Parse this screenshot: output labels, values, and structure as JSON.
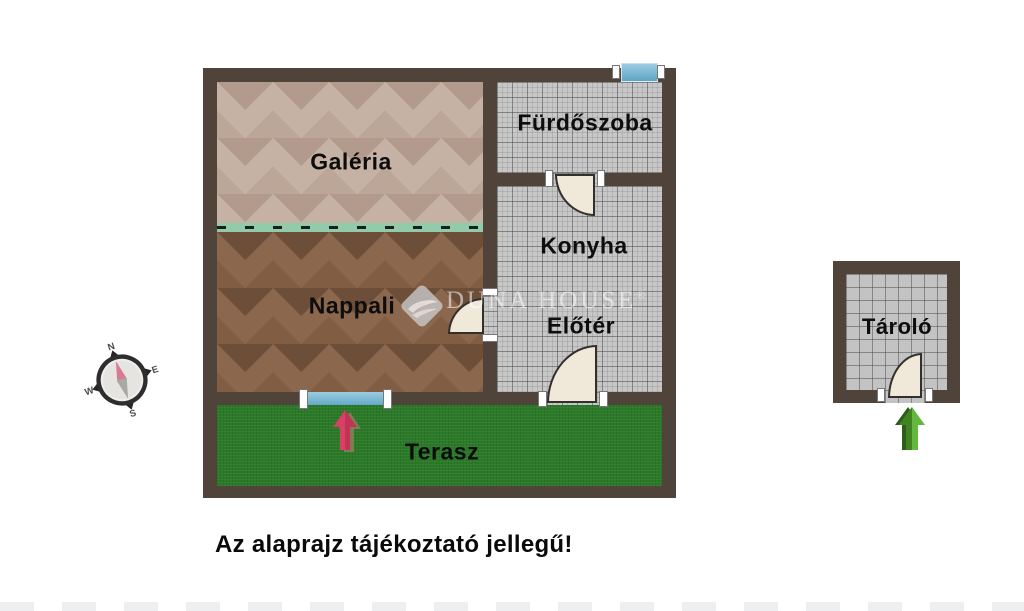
{
  "plan": {
    "rooms": {
      "galeria": {
        "label": "Galéria"
      },
      "nappali": {
        "label": "Nappali"
      },
      "furdoszoba": {
        "label": "Fürdőszoba"
      },
      "konyha": {
        "label": "Konyha"
      },
      "eloter": {
        "label": "Előtér"
      },
      "terasz": {
        "label": "Terasz"
      }
    }
  },
  "outbuilding": {
    "rooms": {
      "tarolo": {
        "label": "Tároló"
      }
    }
  },
  "compass": {
    "north": "N",
    "east": "E",
    "south": "S",
    "west": "W"
  },
  "watermark": {
    "text": "DUNA HOUSE",
    "registered": "®"
  },
  "disclaimer": {
    "text": "Az alaprajz tájékoztató jellegű!"
  },
  "colors": {
    "wall": "#50443a",
    "wood_light": "#c6b2a4",
    "wood_dark": "#8a674d",
    "tile": "#c7c7c7",
    "grass": "#2b7a28",
    "window_blue": "#74b6d4",
    "gallery_edge_green": "#92cbaa",
    "door_leaf": "#f0e9da",
    "entrance_arrow_red": "#d84064",
    "entrance_arrow_green": "#63b93e"
  }
}
